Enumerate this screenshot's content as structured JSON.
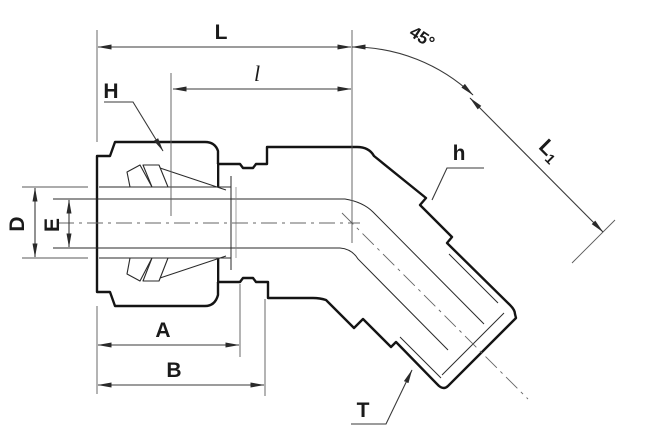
{
  "drawing": {
    "kind": "45-degree male elbow tube fitting, sectioned technical drawing",
    "labels": {
      "overall_length": "L",
      "insertion_length": "l",
      "bend_angle": "45°",
      "nut_hex": "H",
      "body_hex": "h",
      "leg_length_main": "L",
      "leg_length_sub": "1",
      "tube_od": "D",
      "bore_id": "E",
      "dim_a": "A",
      "dim_b": "B",
      "thread": "T"
    },
    "colors": {
      "outline": "#141414",
      "dimension_lines": "#3a3a3a",
      "nut_fill": "#c9c9c9",
      "body_fill": "#e3e3e3",
      "background": "#ffffff"
    }
  }
}
